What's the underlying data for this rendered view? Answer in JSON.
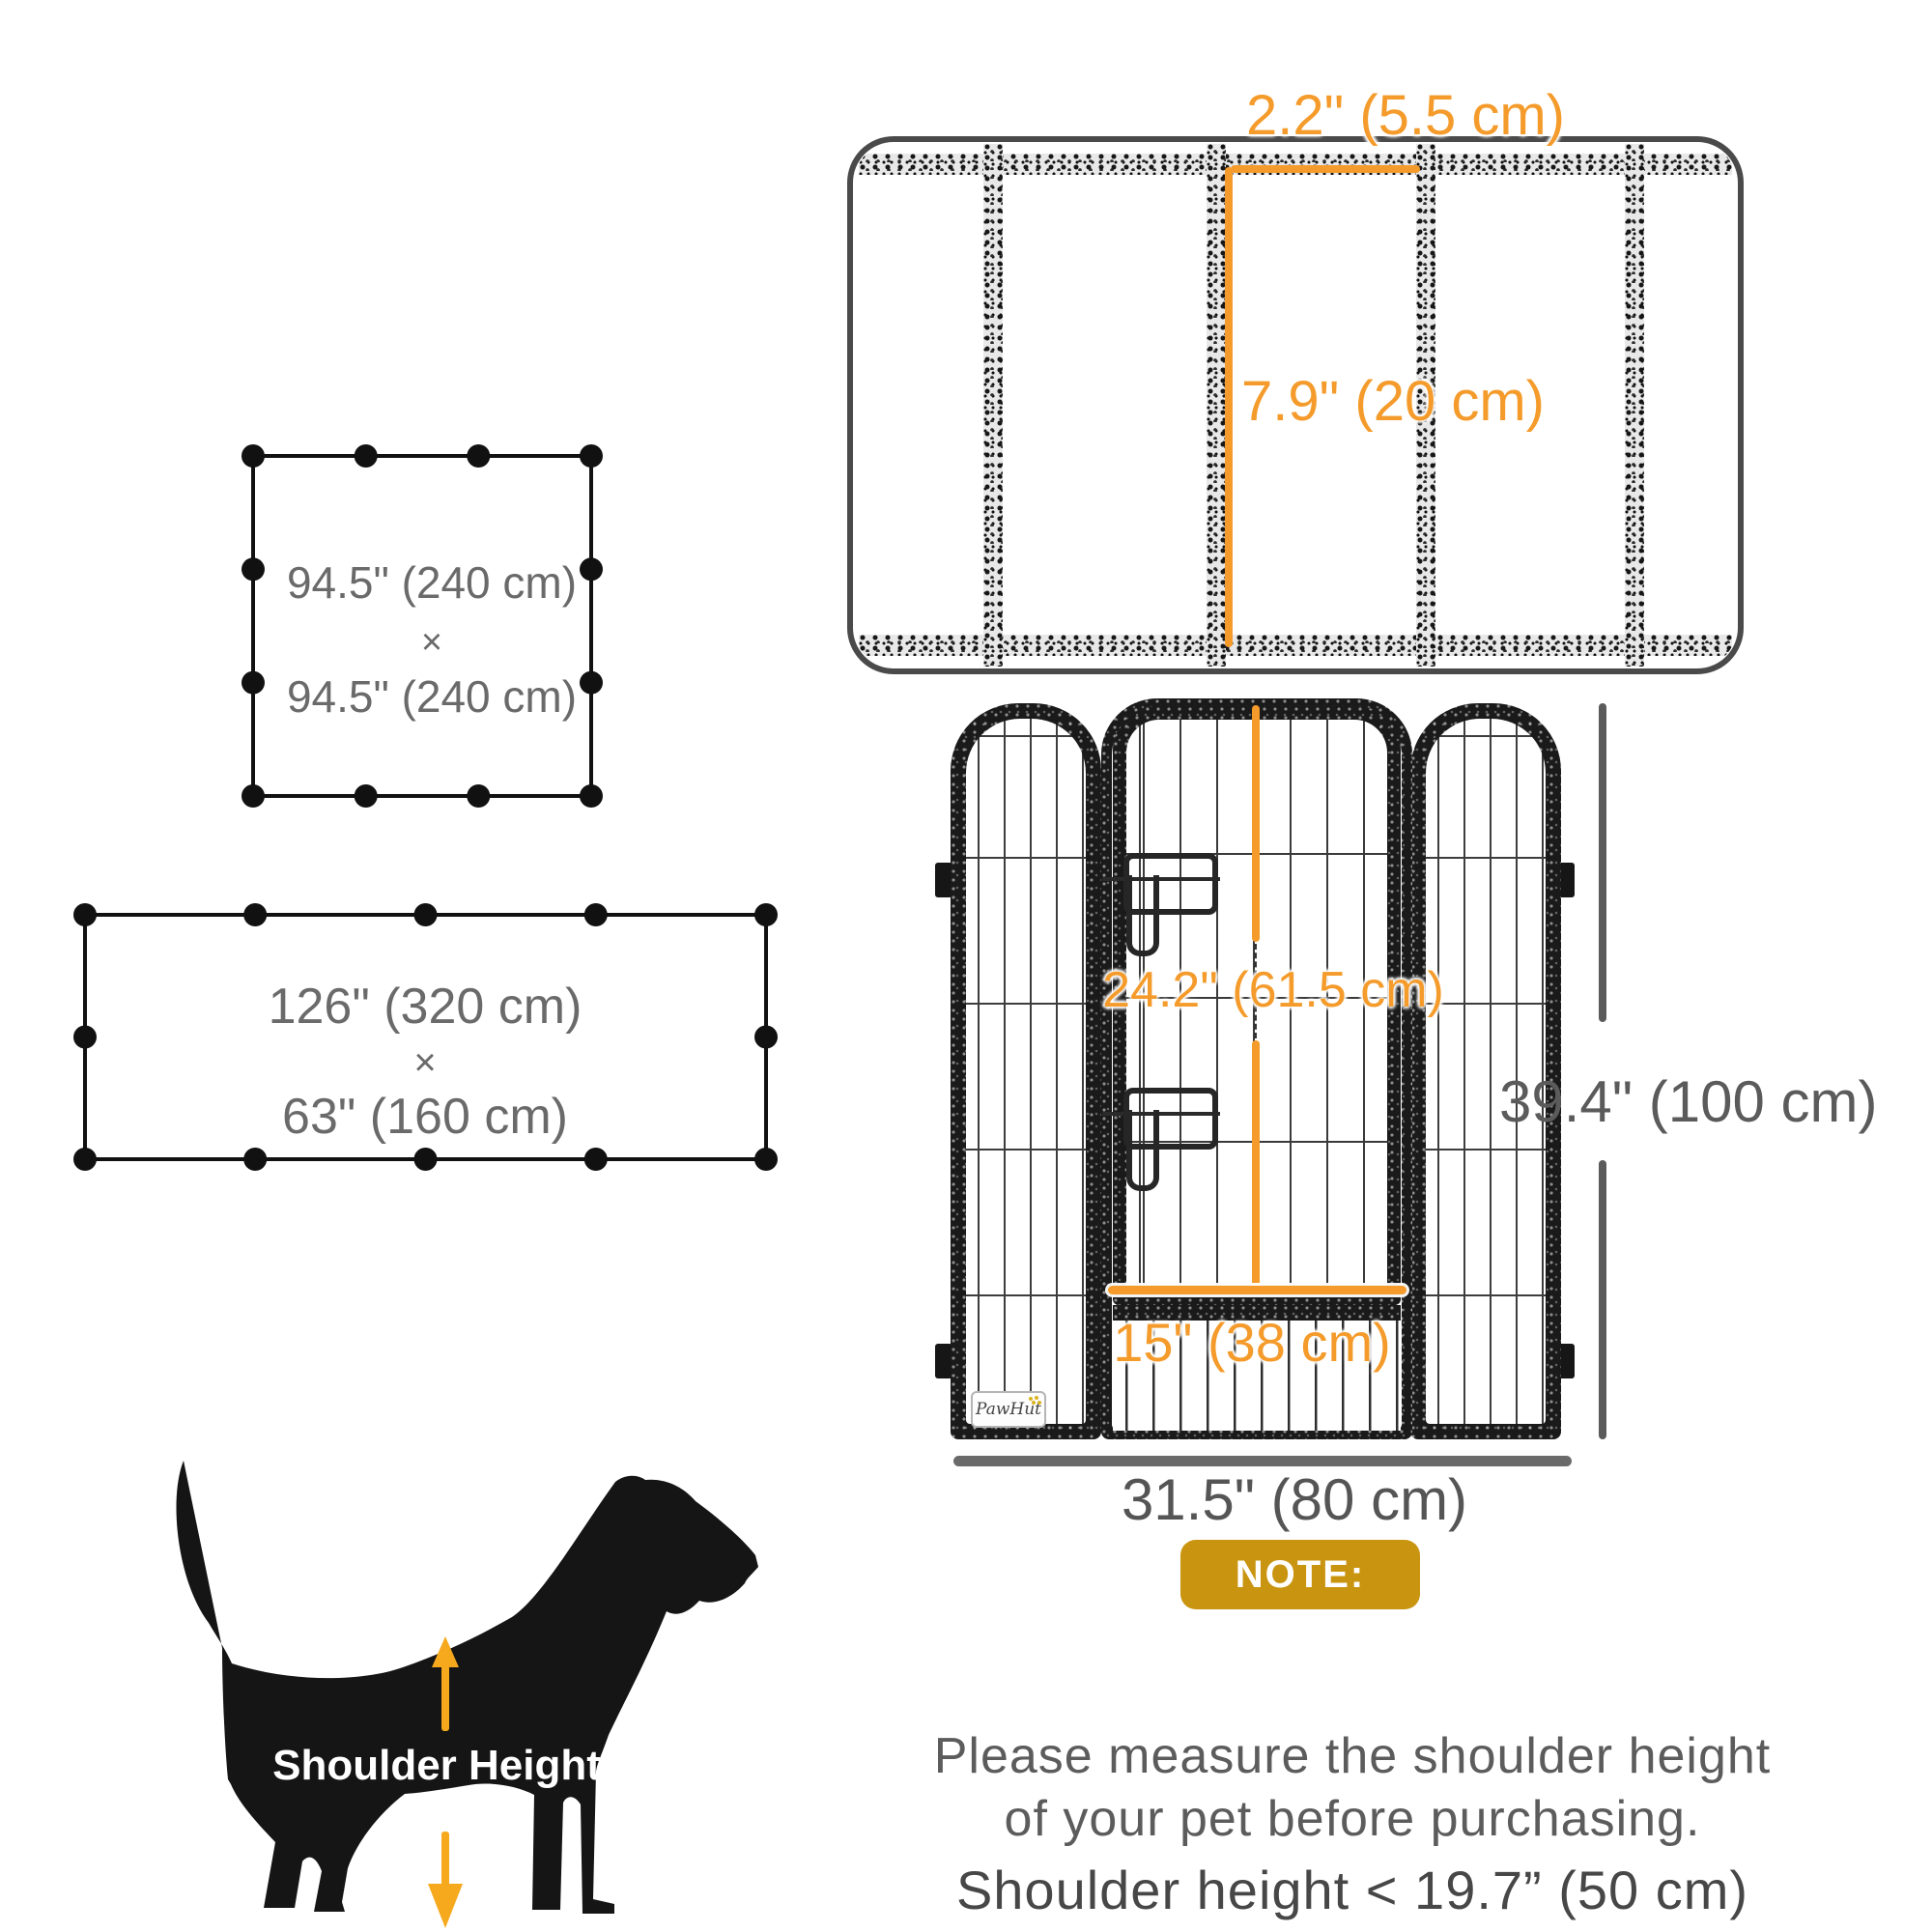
{
  "mesh_detail": {
    "gap_width": "2.2\" (5.5 cm)",
    "section_height": "7.9\" (20 cm)"
  },
  "layout_square": {
    "width": "94.5\" (240 cm)",
    "multiply": "×",
    "height": "94.5\" (240 cm)"
  },
  "layout_rect": {
    "width": "126\" (320 cm)",
    "multiply": "×",
    "height": "63\" (160 cm)"
  },
  "panel_view": {
    "door_height": "24.2\" (61.5 cm)",
    "door_width": "15\" (38 cm)",
    "panel_height": "39.4\" (100 cm)",
    "panel_width": "31.5\" (80 cm)",
    "brand": "PawHut"
  },
  "note": {
    "badge": "NOTE:",
    "line1": "Please measure the shoulder height",
    "line2": "of your pet before purchasing.",
    "line3": "Shoulder height < 19.7” (50 cm)"
  },
  "dog": {
    "label": "Shoulder Height"
  },
  "colors": {
    "accent_orange": "#F49B2B",
    "badge_gold": "#C9940F",
    "arrow_yellow": "#F6A91D",
    "dimension_gray": "#5B5B5B",
    "shape_black": "#111111"
  }
}
